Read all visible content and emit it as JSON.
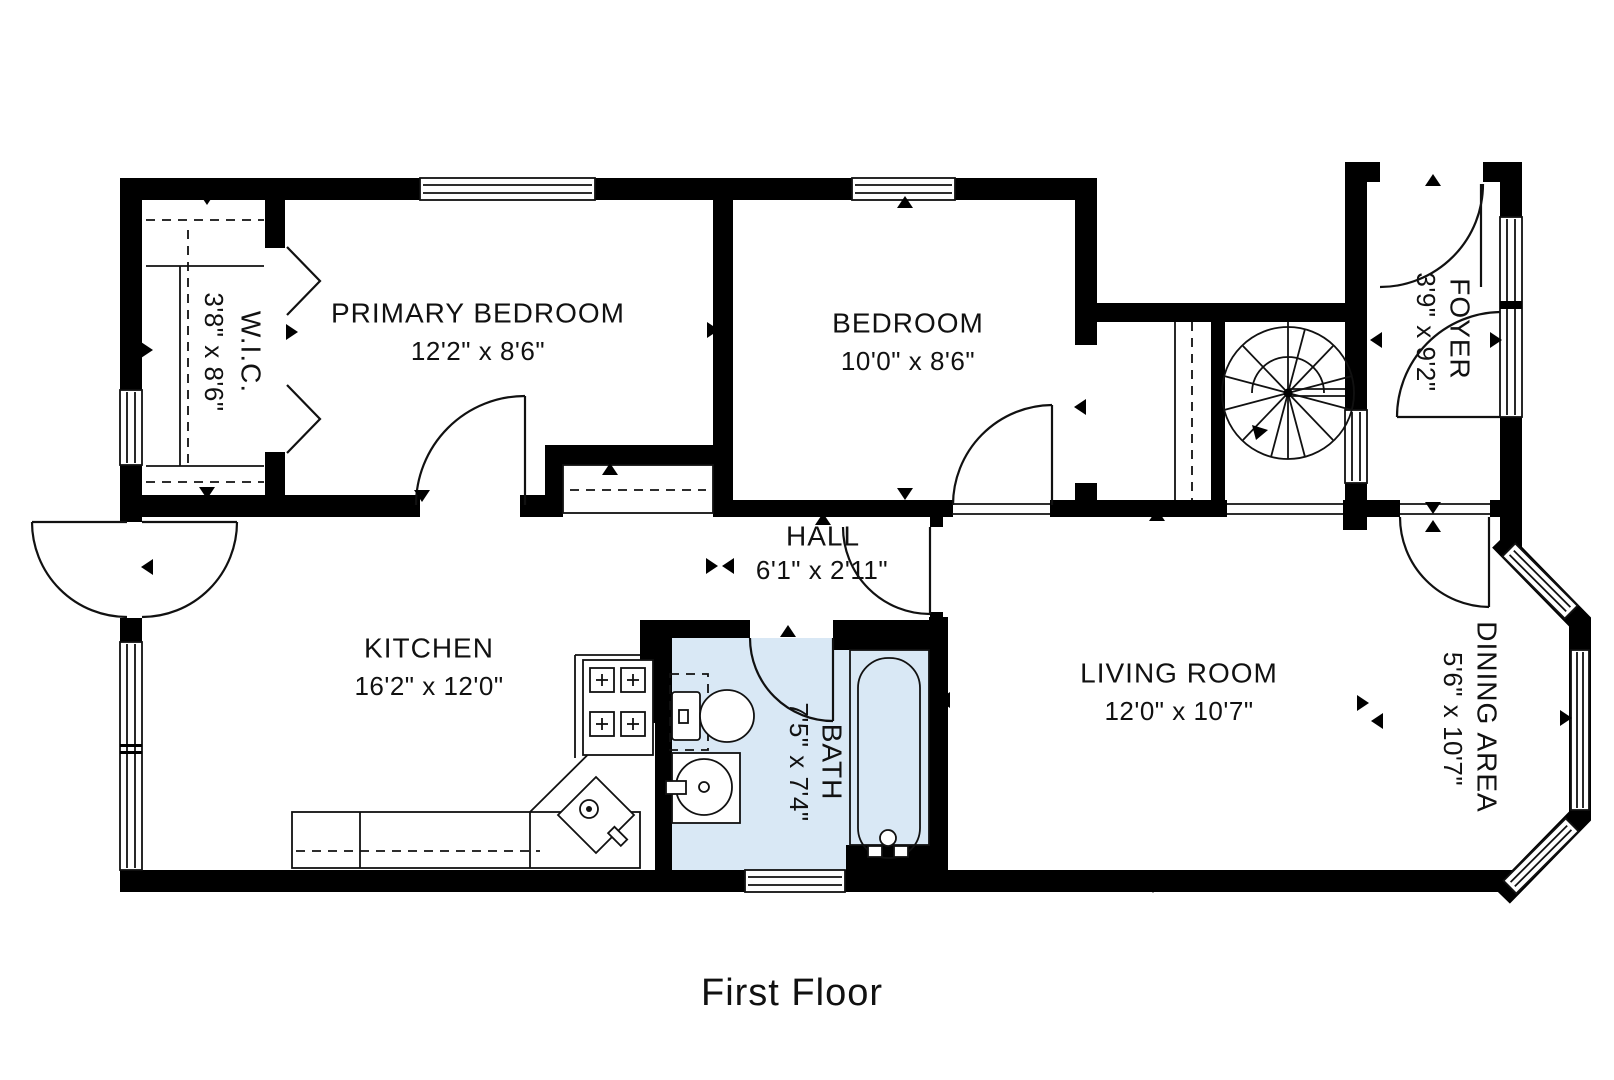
{
  "title": {
    "floor_label": "First Floor"
  },
  "colors": {
    "wall": "#000000",
    "bath_fill": "#d9e8f5",
    "line": "#111111",
    "background": "#ffffff"
  },
  "rooms": [
    {
      "id": "primary-bedroom",
      "name": "PRIMARY BEDROOM",
      "dims": "12'2\" x 8'6\"",
      "orientation": "horizontal"
    },
    {
      "id": "bedroom",
      "name": "BEDROOM",
      "dims": "10'0\" x 8'6\"",
      "orientation": "horizontal"
    },
    {
      "id": "wic",
      "name": "W.I.C.",
      "dims": "3'8\" x 8'6\"",
      "orientation": "vertical"
    },
    {
      "id": "foyer",
      "name": "FOYER",
      "dims": "3'9\" x 9'2\"",
      "orientation": "vertical"
    },
    {
      "id": "hall",
      "name": "HALL",
      "dims": "6'1\" x 2'11\"",
      "orientation": "horizontal"
    },
    {
      "id": "kitchen",
      "name": "KITCHEN",
      "dims": "16'2\" x 12'0\"",
      "orientation": "horizontal"
    },
    {
      "id": "bath",
      "name": "BATH",
      "dims": "7'5\" x 7'4\"",
      "orientation": "vertical"
    },
    {
      "id": "living-room",
      "name": "LIVING ROOM",
      "dims": "12'0\" x 10'7\"",
      "orientation": "horizontal"
    },
    {
      "id": "dining-area",
      "name": "DINING AREA",
      "dims": "5'6\" x 10'7\"",
      "orientation": "vertical"
    }
  ],
  "fixtures": [
    "spiral-staircase",
    "straight-stair",
    "bathtub",
    "toilet",
    "bathroom-sink",
    "kitchen-sink",
    "stove",
    "kitchen-counter",
    "closet-shelving"
  ]
}
